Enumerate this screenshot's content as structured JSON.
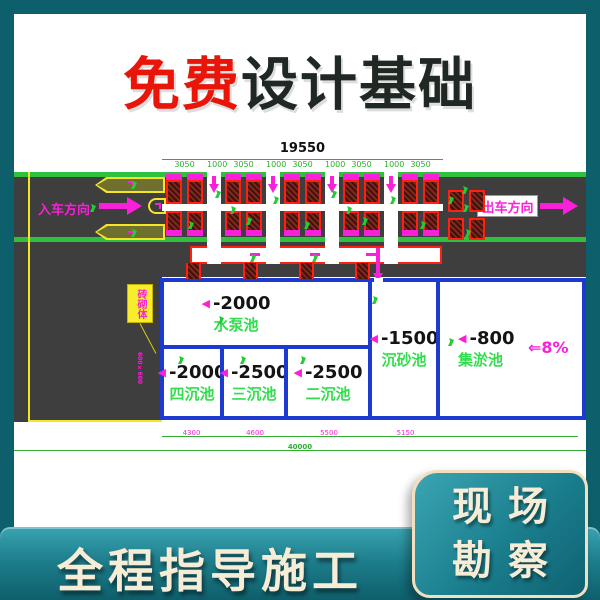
{
  "banner": {
    "free": "免费",
    "rest": "设计基础"
  },
  "drawing": {
    "total_top": "19550",
    "top_segments": [
      "3050",
      "1000",
      "3050",
      "1000",
      "3050",
      "1000",
      "3050",
      "1000",
      "3050"
    ],
    "entry_label": "入车方向",
    "exit_label": "出车方向",
    "annotation_box": "砖砌体",
    "annotation_note": "600×600",
    "pools": [
      {
        "depth": "-2000",
        "name": "水泵池"
      },
      {
        "depth": "-2000",
        "name": "四沉池"
      },
      {
        "depth": "-2500",
        "name": "三沉池"
      },
      {
        "depth": "-2500",
        "name": "二沉池"
      },
      {
        "depth": "-1500",
        "name": "沉砂池"
      },
      {
        "depth": "-800",
        "name": "集淤池"
      }
    ],
    "slope_label": "⇐8%",
    "bottom_segments": [
      "4300",
      "4600",
      "5500",
      "5150"
    ],
    "total_bottom": "40000",
    "marker_glyph": "◀"
  },
  "footer": {
    "slogan": "全程指导施工"
  },
  "badge": {
    "line1": "现场",
    "line2": "勘察"
  },
  "colors": {
    "frame_teal": "#0d5f6b",
    "road_gray": "#3e3e3e",
    "lane_green": "#2fc13d",
    "cad_green": "#33dd4e",
    "cad_magenta": "#fa1fd9",
    "cad_red": "#ff2012",
    "cad_blue": "#1c39d0",
    "cad_yellow": "#f3e52a",
    "title_red": "#e81508",
    "title_dark": "#1f2823",
    "cream": "#f7ecd6"
  }
}
